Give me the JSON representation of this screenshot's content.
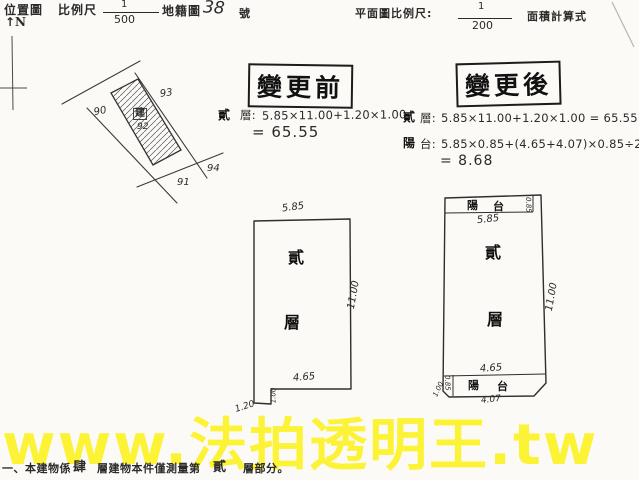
{
  "colors": {
    "paper": "#fbfaf6",
    "ink": "#2a2a2a",
    "watermark_yellow": "#fdf21c"
  },
  "header": {
    "location_map_label": "位置圖",
    "scale_label": "比例尺",
    "scale_numerator": "1",
    "scale_denominator": "500",
    "cadastral_map_label": "地籍圖",
    "sheet_number": "38",
    "sheet_suffix": "號",
    "compass_arrow": "↑",
    "compass_letter": "N",
    "plan_scale_label": "平面圖比例尺:",
    "plan_scale_numerator": "1",
    "plan_scale_denominator": "200",
    "area_formula_label": "面積計算式"
  },
  "sketch": {
    "parcel_90": "90",
    "parcel_91": "91",
    "parcel_92": "92",
    "parcel_93": "93",
    "parcel_94": "94",
    "building_mark": "建"
  },
  "before": {
    "stamp": "變更前",
    "floor_prefix": "貳",
    "floor_label": "層:",
    "floor_formula": "5.85×11.00+1.20×1.00",
    "floor_result": "= 65.55"
  },
  "after": {
    "stamp": "變更後",
    "floor_prefix": "貳",
    "floor_label": "層:",
    "floor_formula": "5.85×11.00+1.20×1.00 = 65.55",
    "balcony_prefix": "陽",
    "balcony_label": "台:",
    "balcony_formula": "5.85×0.85+(4.65+4.07)×0.85÷2",
    "balcony_result": "= 8.68"
  },
  "plan_before": {
    "width_top": "5.85",
    "height_right": "11.00",
    "width_bottom": "4.65",
    "notch_height": "1.00",
    "notch_width": "1.20",
    "floor_char_1": "貳",
    "floor_char_2": "層"
  },
  "plan_after": {
    "balcony_top_char_1": "陽",
    "balcony_top_char_2": "台",
    "balcony_end_top": "0.85",
    "width_top": "5.85",
    "height_right": "11.00",
    "width_inner_bottom": "4.65",
    "balcony_bottom_char_1": "陽",
    "balcony_bottom_char_2": "台",
    "width_bottom": "4.07",
    "left_dim_long": "1.00",
    "left_dim_short": "0.85",
    "floor_char_1": "貳",
    "floor_char_2": "層"
  },
  "watermark": {
    "text": "www.法拍透明王.tw"
  },
  "footer": {
    "prefix": "一、本建物係",
    "total_floors": "肆",
    "middle": "層建物本件僅測量第",
    "measured_floor": "貳",
    "suffix": "層部分。"
  }
}
